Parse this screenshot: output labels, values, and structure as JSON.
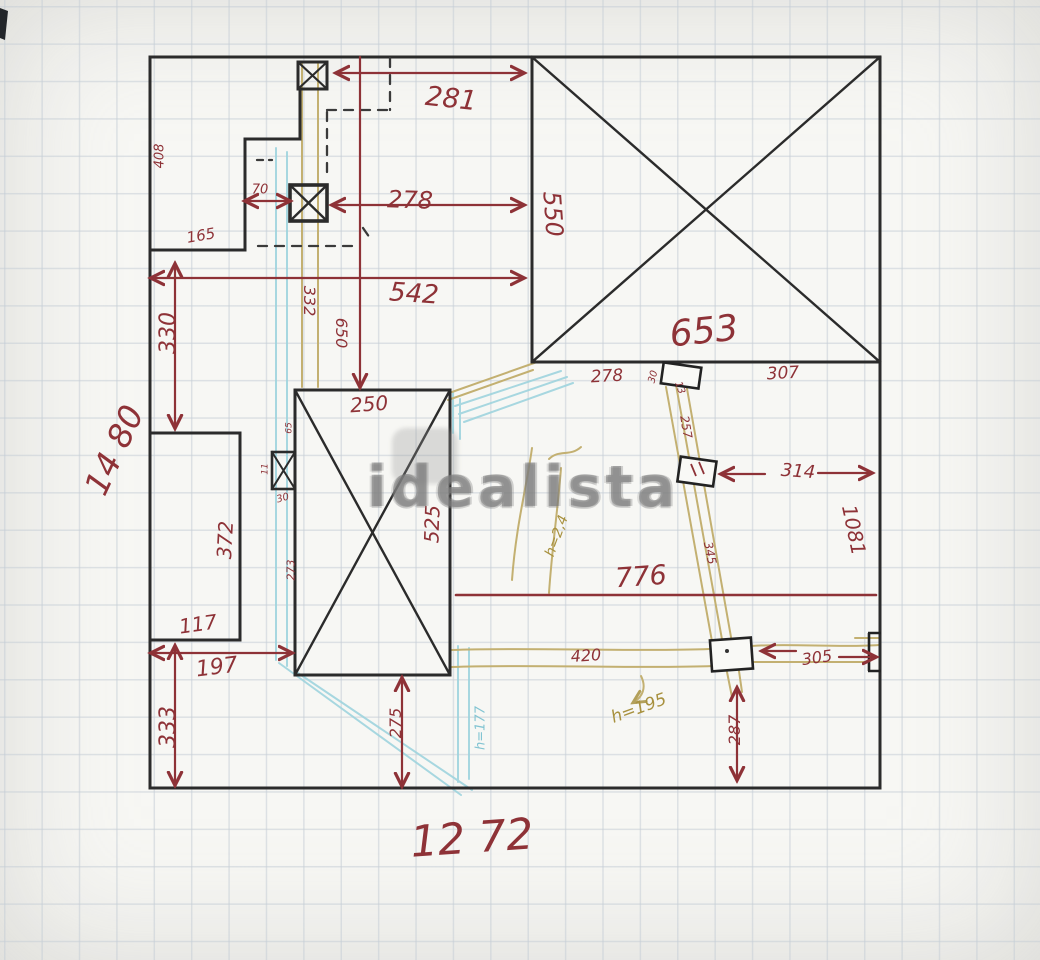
{
  "watermark": {
    "text": "idealista"
  },
  "colors": {
    "ink_red": "#8e3237",
    "ink_tan": "#a8913f",
    "ink_blue": "#82c4d2",
    "wall_black": "#2b2b2b",
    "grid_line": "#c6ced6",
    "watermark_gray": "#7a7a7a"
  },
  "labels": {
    "dim_281": "281",
    "dim_278_top": "278",
    "dim_70": "70",
    "room_165": "165",
    "wall_408": "408",
    "dim_542": "542",
    "dim_332": "332",
    "dim_650": "650",
    "dim_550": "550",
    "room_653": "653",
    "dim_278_bottom": "278",
    "dim_30_top": "30",
    "dim_13": "13",
    "dim_307": "307",
    "dim_257": "257",
    "dim_314": "314",
    "dim_1081": "1081",
    "dim_776": "776",
    "dim_345": "345",
    "dim_420": "420",
    "dim_305": "305",
    "dim_287": "287",
    "dim_275": "275",
    "height_177": "h=177",
    "height_195": "h=195",
    "height_24": "h=2,4",
    "dim_250": "250",
    "dim_525": "525",
    "dim_273": "273",
    "dim_65": "65",
    "dim_11": "11",
    "dim_30_left": "30",
    "dim_197": "197",
    "dim_333": "333",
    "dim_330": "330",
    "total_height": "14 80",
    "room_372": "372",
    "room_117": "117",
    "total_width": "12 72"
  }
}
